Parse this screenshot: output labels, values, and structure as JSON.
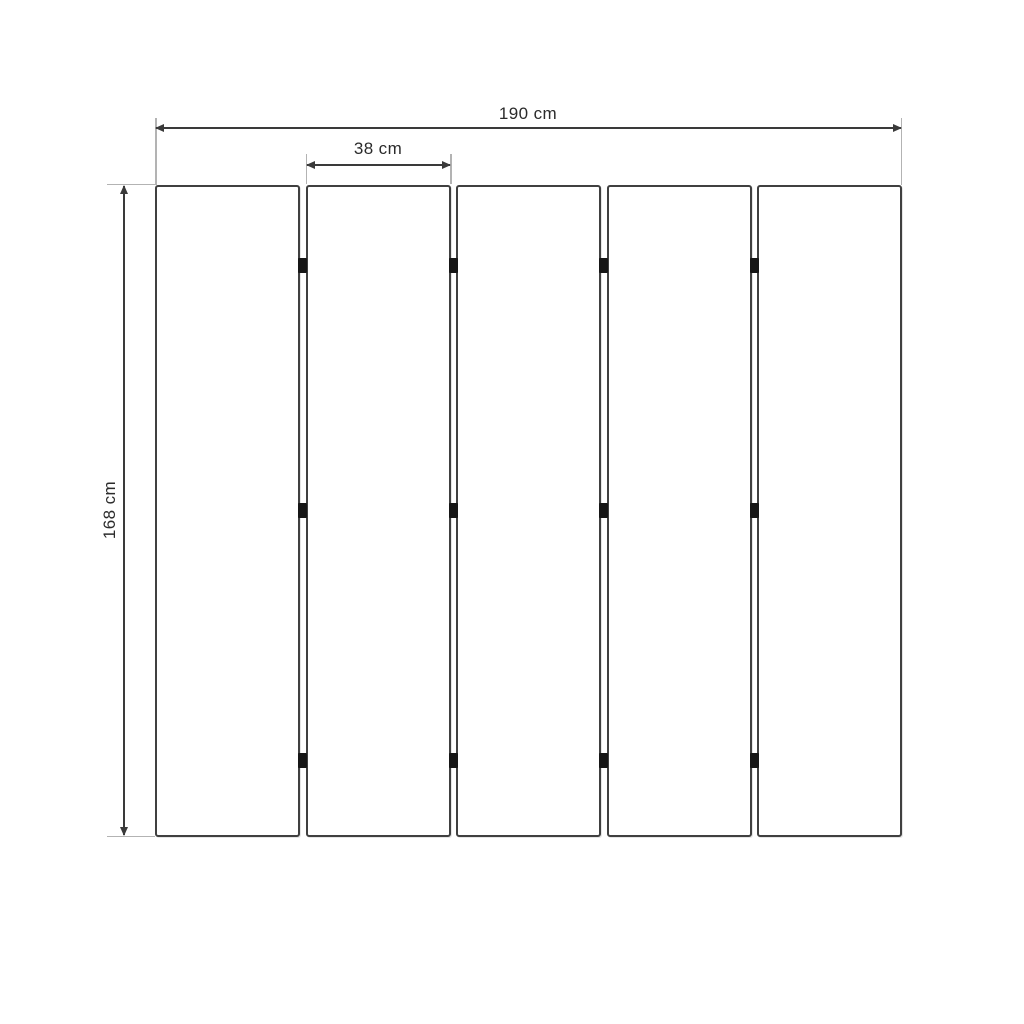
{
  "diagram": {
    "type": "dimension-drawing",
    "subject": "five-panel folding screen front elevation",
    "colors": {
      "dimension_line": "#3a3a3a",
      "extension_line": "#b3b3b3",
      "panel_border": "#404040",
      "panel_fill": "#ffffff",
      "hinge": "#161616",
      "label_text": "#2b2b2b",
      "background": "#ffffff"
    },
    "panels": {
      "count": 5,
      "gaps": 4,
      "hinges_per_gap": 3
    },
    "dimensions": {
      "total_width": {
        "label": "190 cm"
      },
      "panel_width": {
        "label": "38 cm"
      },
      "height": {
        "label": "168 cm"
      }
    }
  }
}
